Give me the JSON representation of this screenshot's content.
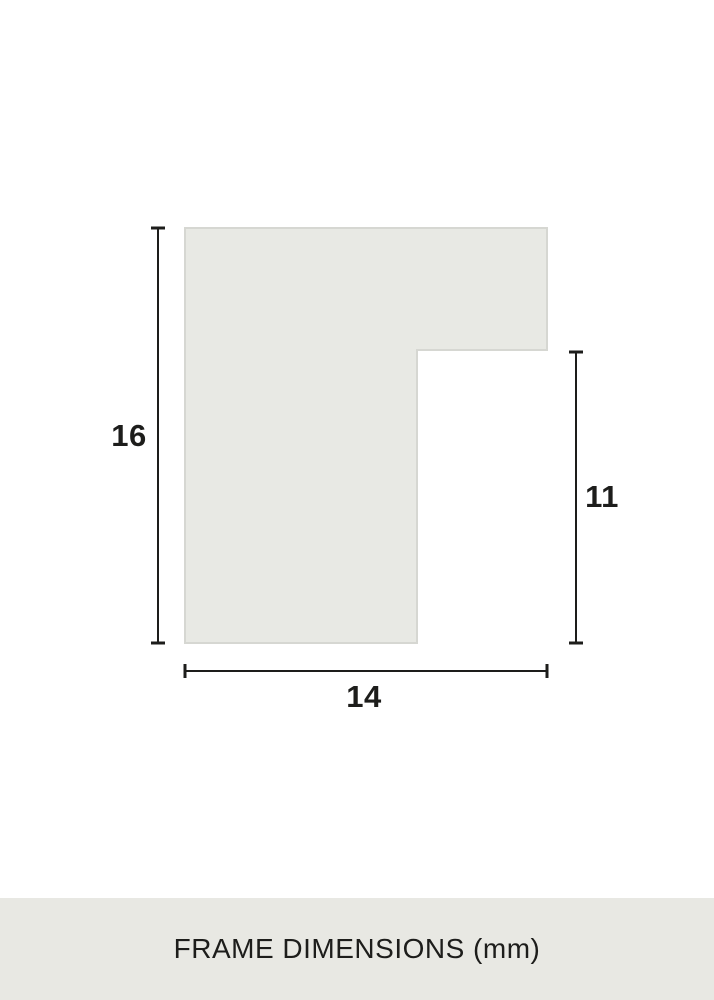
{
  "diagram": {
    "type": "frame-profile-cross-section",
    "unit": "mm",
    "colors": {
      "background": "#ffffff",
      "shape_fill": "#e8e9e4",
      "shape_border": "#d6d7d2",
      "line": "#1d1d1b",
      "text": "#1d1d1b"
    },
    "dimensions": [
      {
        "id": "profile-height",
        "side": "left",
        "value": "16"
      },
      {
        "id": "inner-height",
        "side": "right",
        "value": "11"
      },
      {
        "id": "profile-width",
        "side": "bottom",
        "value": "14"
      }
    ]
  },
  "footer": {
    "label": "FRAME DIMENSIONS (mm)",
    "background": "#e8e8e3"
  }
}
